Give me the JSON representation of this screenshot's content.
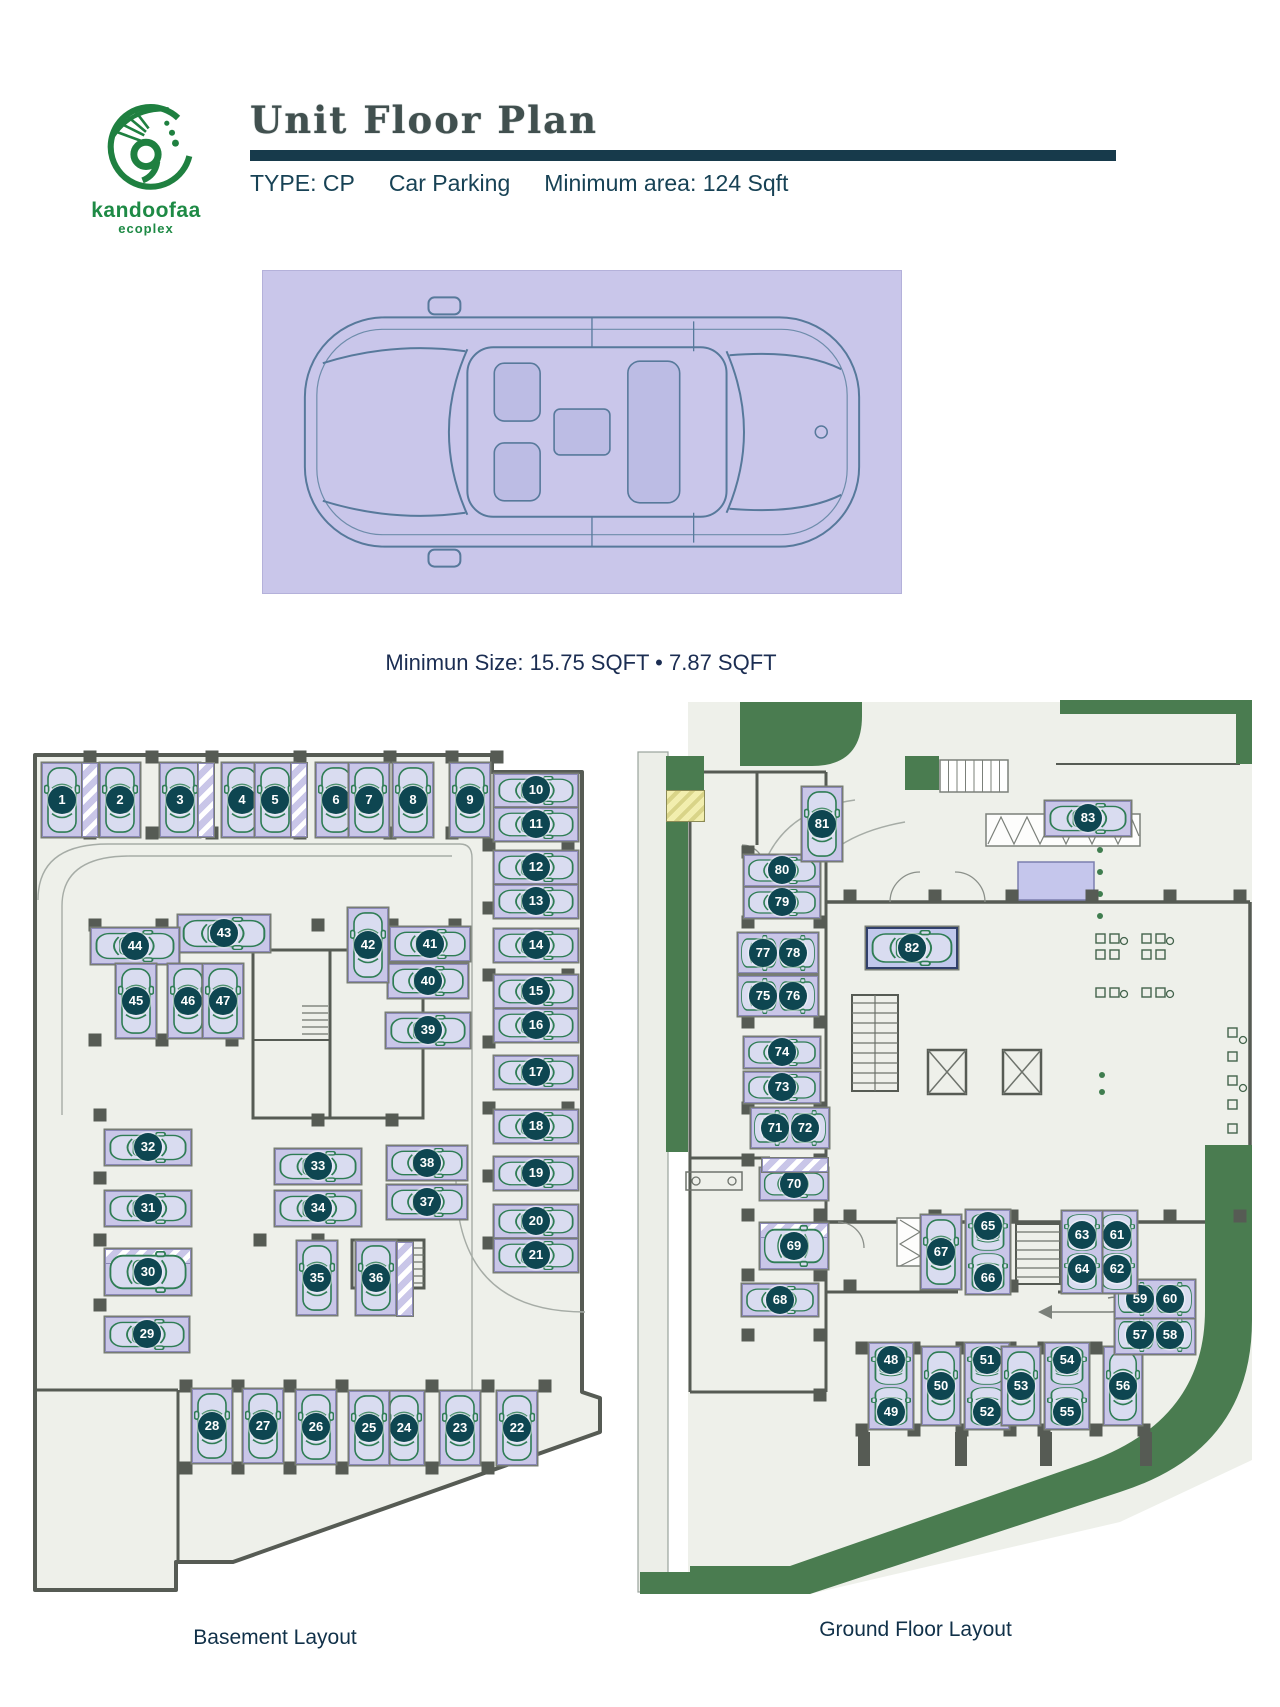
{
  "brand": {
    "name": "kandoofaa",
    "tagline": "ecoplex"
  },
  "header": {
    "title": "Unit Floor Plan",
    "type_label": "TYPE: CP",
    "category": "Car Parking",
    "min_area": "Minimum area: 124 Sqft"
  },
  "car_figure": {
    "caption": "Minimun Size: 15.75 SQFT • 7.87 SQFT"
  },
  "colors": {
    "accent_teal": "#173a4b",
    "badge": "#0e4651",
    "stall_lavender": "#c9c6e8",
    "landscape_green": "#4a7c50",
    "floor": "#eef0ea",
    "wall": "#565b54",
    "car_green": "#2f7d55",
    "hatch_yellow": "#f2eeae",
    "logo_green": "#1e8a45",
    "text_dark": "#174255"
  },
  "plans": [
    {
      "id": "basement",
      "label": "Basement Layout",
      "spots": [
        {
          "n": [
            "1"
          ],
          "x": 62,
          "y": 800,
          "o": "v"
        },
        {
          "n": [
            "2"
          ],
          "x": 120,
          "y": 800,
          "o": "v"
        },
        {
          "n": [
            "3"
          ],
          "x": 180,
          "y": 800,
          "o": "v"
        },
        {
          "n": [
            "4"
          ],
          "x": 242,
          "y": 800,
          "o": "v"
        },
        {
          "n": [
            "5"
          ],
          "x": 275,
          "y": 800,
          "o": "v"
        },
        {
          "n": [
            "6"
          ],
          "x": 336,
          "y": 800,
          "o": "v"
        },
        {
          "n": [
            "7"
          ],
          "x": 369,
          "y": 800,
          "o": "v"
        },
        {
          "n": [
            "8"
          ],
          "x": 413,
          "y": 800,
          "o": "v"
        },
        {
          "n": [
            "9"
          ],
          "x": 470,
          "y": 800,
          "o": "v"
        },
        {
          "n": [
            "10"
          ],
          "x": 536,
          "y": 790,
          "o": "h",
          "w": 84,
          "h": 33
        },
        {
          "n": [
            "11"
          ],
          "x": 536,
          "y": 824,
          "o": "h",
          "w": 84,
          "h": 33
        },
        {
          "n": [
            "12"
          ],
          "x": 536,
          "y": 867,
          "o": "h",
          "w": 84,
          "h": 33
        },
        {
          "n": [
            "13"
          ],
          "x": 536,
          "y": 901,
          "o": "h",
          "w": 84,
          "h": 33
        },
        {
          "n": [
            "14"
          ],
          "x": 536,
          "y": 945,
          "o": "h",
          "w": 84,
          "h": 33
        },
        {
          "n": [
            "15"
          ],
          "x": 536,
          "y": 991,
          "o": "h",
          "w": 84,
          "h": 33
        },
        {
          "n": [
            "16"
          ],
          "x": 536,
          "y": 1025,
          "o": "h",
          "w": 84,
          "h": 33
        },
        {
          "n": [
            "17"
          ],
          "x": 536,
          "y": 1072,
          "o": "h",
          "w": 84,
          "h": 33
        },
        {
          "n": [
            "18"
          ],
          "x": 536,
          "y": 1126,
          "o": "h",
          "w": 84,
          "h": 33
        },
        {
          "n": [
            "19"
          ],
          "x": 536,
          "y": 1173,
          "o": "h",
          "w": 84,
          "h": 33
        },
        {
          "n": [
            "20"
          ],
          "x": 536,
          "y": 1221,
          "o": "h",
          "w": 84,
          "h": 33
        },
        {
          "n": [
            "21"
          ],
          "x": 536,
          "y": 1255,
          "o": "h",
          "w": 84,
          "h": 33
        },
        {
          "n": [
            "22"
          ],
          "x": 517,
          "y": 1428,
          "o": "v"
        },
        {
          "n": [
            "23"
          ],
          "x": 460,
          "y": 1428,
          "o": "v"
        },
        {
          "n": [
            "24"
          ],
          "x": 404,
          "y": 1428,
          "o": "v"
        },
        {
          "n": [
            "25"
          ],
          "x": 369,
          "y": 1428,
          "o": "v"
        },
        {
          "n": [
            "26"
          ],
          "x": 316,
          "y": 1427,
          "o": "v"
        },
        {
          "n": [
            "27"
          ],
          "x": 263,
          "y": 1426,
          "o": "v"
        },
        {
          "n": [
            "28"
          ],
          "x": 212,
          "y": 1426,
          "o": "v"
        },
        {
          "n": [
            "29"
          ],
          "x": 147,
          "y": 1334,
          "o": "h",
          "w": 84,
          "h": 35
        },
        {
          "n": [
            "30"
          ],
          "x": 148,
          "y": 1272,
          "o": "h",
          "w": 86,
          "h": 46,
          "ht": true
        },
        {
          "n": [
            "31"
          ],
          "x": 148,
          "y": 1208,
          "o": "h"
        },
        {
          "n": [
            "32"
          ],
          "x": 148,
          "y": 1147,
          "o": "h"
        },
        {
          "n": [
            "33"
          ],
          "x": 318,
          "y": 1166,
          "o": "h"
        },
        {
          "n": [
            "34"
          ],
          "x": 318,
          "y": 1208,
          "o": "h"
        },
        {
          "n": [
            "35"
          ],
          "x": 317,
          "y": 1278,
          "o": "v"
        },
        {
          "n": [
            "36"
          ],
          "x": 376,
          "y": 1278,
          "o": "v"
        },
        {
          "n": [
            "37"
          ],
          "x": 427,
          "y": 1202,
          "o": "h",
          "w": 80,
          "h": 34
        },
        {
          "n": [
            "38"
          ],
          "x": 427,
          "y": 1163,
          "o": "h",
          "w": 80,
          "h": 34
        },
        {
          "n": [
            "39"
          ],
          "x": 428,
          "y": 1030,
          "o": "h",
          "w": 84,
          "h": 35
        },
        {
          "n": [
            "40"
          ],
          "x": 428,
          "y": 981,
          "o": "h",
          "w": 80,
          "h": 34
        },
        {
          "n": [
            "41"
          ],
          "x": 430,
          "y": 944,
          "o": "h",
          "w": 80,
          "h": 34
        },
        {
          "n": [
            "42"
          ],
          "x": 368,
          "y": 945,
          "o": "v"
        },
        {
          "n": [
            "43"
          ],
          "x": 224,
          "y": 933,
          "o": "h",
          "w": 92,
          "h": 37
        },
        {
          "n": [
            "44"
          ],
          "x": 135,
          "y": 946,
          "o": "h",
          "w": 88,
          "h": 36
        },
        {
          "n": [
            "45"
          ],
          "x": 136,
          "y": 1001,
          "o": "v"
        },
        {
          "n": [
            "46"
          ],
          "x": 188,
          "y": 1001,
          "o": "v"
        },
        {
          "n": [
            "47"
          ],
          "x": 223,
          "y": 1001,
          "o": "v"
        }
      ]
    },
    {
      "id": "ground",
      "label": "Ground Floor Layout",
      "spots": [
        {
          "n": [
            "48",
            "49"
          ],
          "x": 891,
          "y": 1386,
          "o": "v"
        },
        {
          "n": [
            "50"
          ],
          "x": 941,
          "y": 1386,
          "o": "v",
          "w": 38,
          "h": 78
        },
        {
          "n": [
            "51",
            "52"
          ],
          "x": 987,
          "y": 1386,
          "o": "v"
        },
        {
          "n": [
            "53"
          ],
          "x": 1021,
          "y": 1386,
          "o": "v",
          "w": 38,
          "h": 78
        },
        {
          "n": [
            "54",
            "55"
          ],
          "x": 1067,
          "y": 1386,
          "o": "v"
        },
        {
          "n": [
            "56"
          ],
          "x": 1123,
          "y": 1386,
          "o": "v",
          "w": 38,
          "h": 78
        },
        {
          "n": [
            "57",
            "58"
          ],
          "x": 1155,
          "y": 1335,
          "o": "h",
          "w": 80,
          "h": 38
        },
        {
          "n": [
            "59",
            "60"
          ],
          "x": 1155,
          "y": 1299,
          "o": "h",
          "w": 80,
          "h": 38
        },
        {
          "n": [
            "61",
            "62"
          ],
          "x": 1117,
          "y": 1252,
          "o": "v",
          "w": 40,
          "h": 82
        },
        {
          "n": [
            "63",
            "64"
          ],
          "x": 1082,
          "y": 1252,
          "o": "v",
          "w": 40,
          "h": 82
        },
        {
          "n": [
            "65",
            "66"
          ],
          "x": 988,
          "y": 1252,
          "o": "v",
          "w": 44,
          "h": 84
        },
        {
          "n": [
            "67"
          ],
          "x": 941,
          "y": 1252,
          "o": "v"
        },
        {
          "n": [
            "68"
          ],
          "x": 780,
          "y": 1300,
          "o": "h",
          "w": 76,
          "h": 32
        },
        {
          "n": [
            "69"
          ],
          "x": 794,
          "y": 1246,
          "o": "h",
          "w": 68,
          "h": 46,
          "ht": true
        },
        {
          "n": [
            "70"
          ],
          "x": 794,
          "y": 1184,
          "o": "h",
          "w": 68,
          "h": 32
        },
        {
          "n": [
            "71",
            "72"
          ],
          "x": 790,
          "y": 1128,
          "o": "h",
          "w": 78,
          "h": 40
        },
        {
          "n": [
            "73"
          ],
          "x": 782,
          "y": 1087,
          "o": "h",
          "w": 76,
          "h": 31
        },
        {
          "n": [
            "74"
          ],
          "x": 782,
          "y": 1052,
          "o": "h",
          "w": 76,
          "h": 31
        },
        {
          "n": [
            "75",
            "76"
          ],
          "x": 778,
          "y": 996,
          "o": "h",
          "w": 80,
          "h": 40
        },
        {
          "n": [
            "77",
            "78"
          ],
          "x": 778,
          "y": 953,
          "o": "h",
          "w": 80,
          "h": 40
        },
        {
          "n": [
            "79"
          ],
          "x": 782,
          "y": 902,
          "o": "h",
          "w": 76,
          "h": 31
        },
        {
          "n": [
            "80"
          ],
          "x": 782,
          "y": 870,
          "o": "h",
          "w": 76,
          "h": 31
        },
        {
          "n": [
            "81"
          ],
          "x": 822,
          "y": 824,
          "o": "v"
        },
        {
          "n": [
            "82"
          ],
          "x": 912,
          "y": 948,
          "o": "h",
          "w": 92,
          "h": 42,
          "hl": true
        },
        {
          "n": [
            "83"
          ],
          "x": 1088,
          "y": 818,
          "o": "h",
          "w": 86,
          "h": 35
        }
      ]
    }
  ]
}
